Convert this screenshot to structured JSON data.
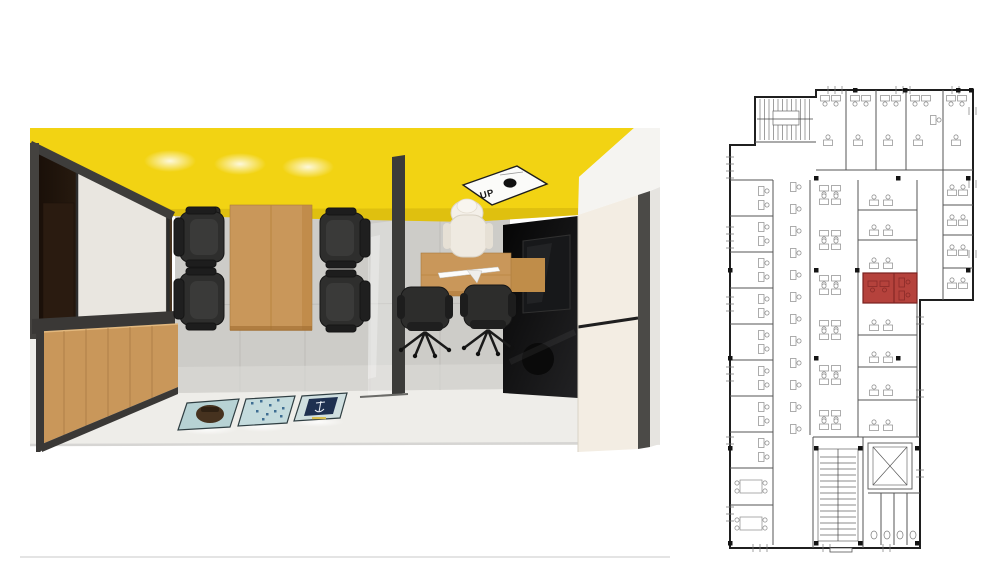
{
  "page": {
    "background": "#FFFFFF"
  },
  "colors": {
    "background": "#FFFFFF",
    "ceiling": "#F2D313",
    "wood": "#C9975A",
    "panel": "#F3EDE3",
    "highlight": "#B5423C",
    "chair": "#2E2E2D",
    "plan_ink": "#4A4A4A"
  },
  "render": {
    "description": "top-down 3D render of meeting room and adjacent office",
    "ceiling_sign": {
      "label": "UP"
    }
  },
  "floorplan": {
    "description": "office floor plan with one room highlighted",
    "highlight_color": "#B5423C"
  }
}
